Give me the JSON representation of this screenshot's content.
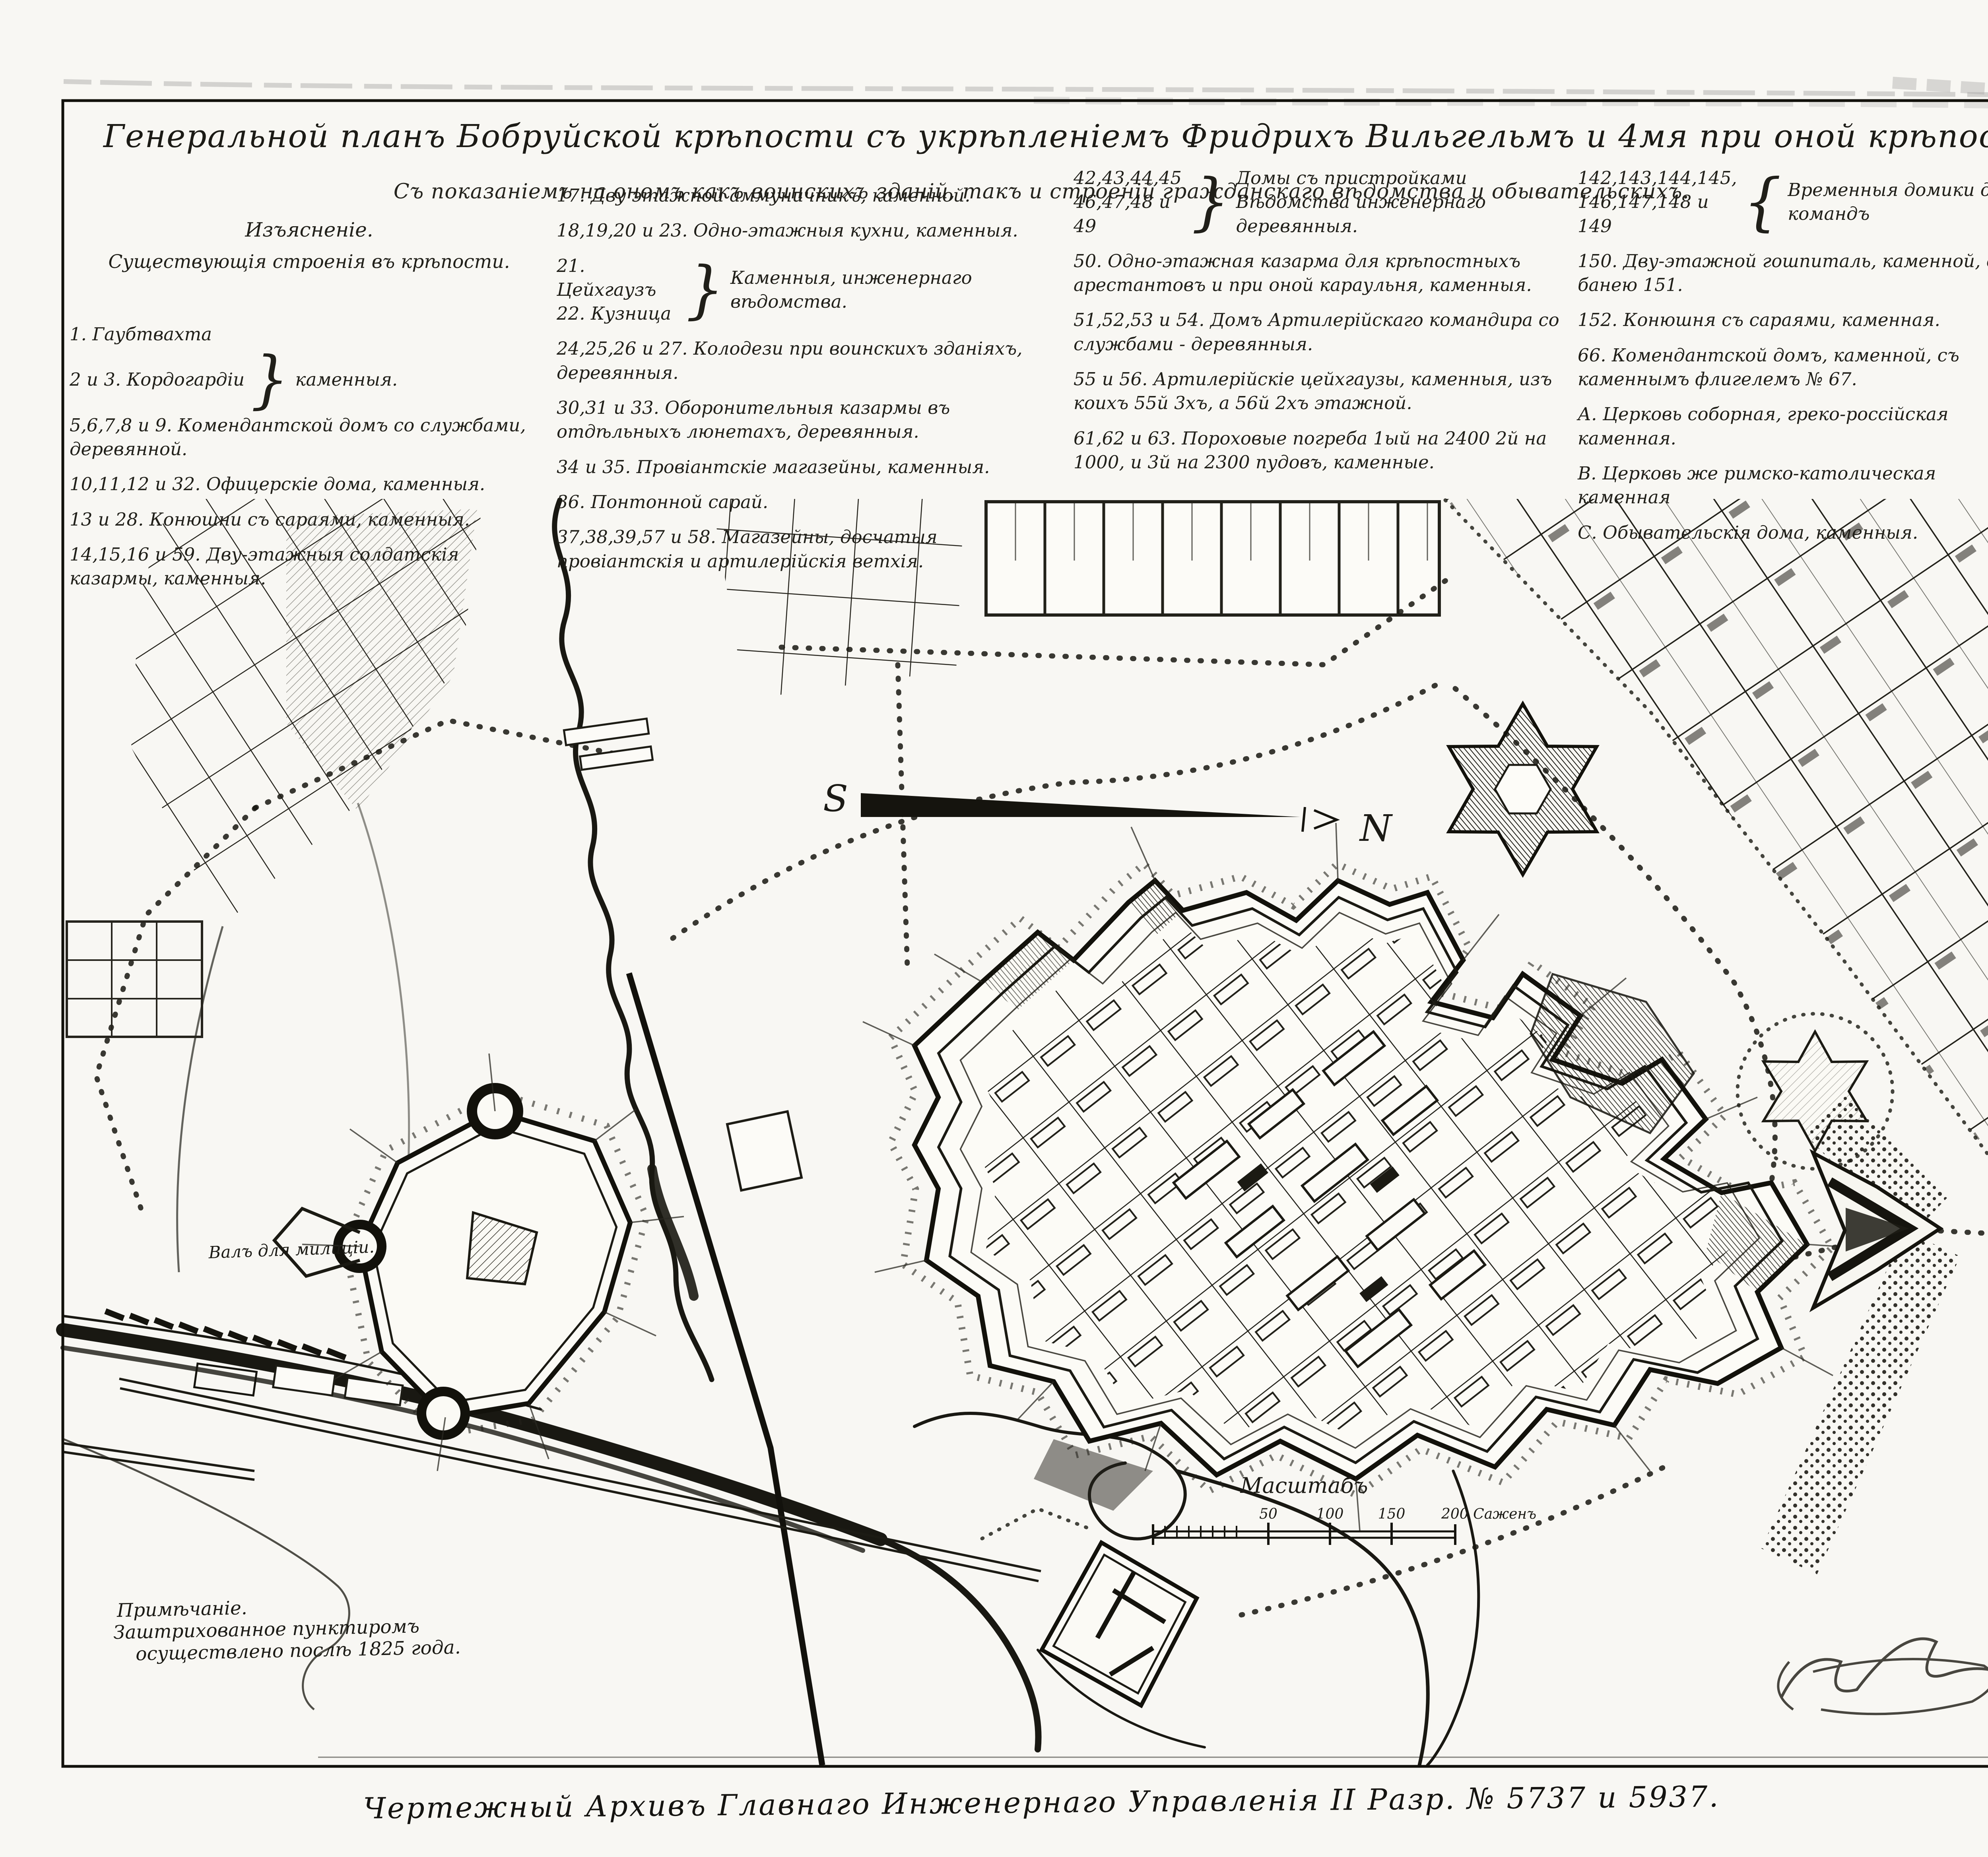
{
  "title": {
    "line1": "Генеральной планъ Бобруйской крѣпости съ укрѣпленіемъ Фридрихъ Вильгельмъ и 4мя при оной крѣпости форштатами.",
    "line2": "Съ показаніемъ на ономъ какъ воинскихъ зданій, такъ и строеній гражданскаго вѣдомства и обывательскихъ."
  },
  "legend": {
    "heading1": "Изъясненіе.",
    "heading2": "Существующія строенія въ крѣпости.",
    "col1": [
      {
        "t": "1. Гаубтвахта"
      },
      {
        "n1": "2 и 3. Кордогардіи",
        "d": "каменныя."
      },
      {
        "t": "5,6,7,8 и 9. Комендантской домъ со службами, деревянной."
      },
      {
        "t": "10,11,12 и 32. Офицерскіе дома, каменныя."
      },
      {
        "t": "13 и 28. Конюшни съ сараями, каменныя."
      },
      {
        "t": "14,15,16 и 59. Дву-этажныя солдатскія казармы, каменныя."
      }
    ],
    "col2": [
      {
        "t": "17. Дву этажной аммуничникъ, каменной."
      },
      {
        "t": "18,19,20 и 23. Одно-этажныя кухни, каменныя."
      },
      {
        "n1": "21. Цейхгаузъ",
        "n2": "22. Кузница",
        "d": "Каменныя, инженернаго вѣдомства."
      },
      {
        "t": "24,25,26 и 27. Колодези при воинскихъ зданіяхъ, деревянныя."
      },
      {
        "t": "30,31 и 33. Оборонительныя казармы въ отдѣльныхъ люнетахъ, деревянныя."
      },
      {
        "t": "34 и 35. Провіантскіе магазейны, каменныя."
      },
      {
        "t": "36. Понтонной сарай."
      },
      {
        "t": "37,38,39,57 и 58. Магазейны, досчатыя провіантскія и артилерійскія ветхія."
      }
    ],
    "col3": [
      {
        "n1": "42,43,44,45",
        "n2": "46,47,48 и 49",
        "d1": "Домы съ пристройками",
        "d2": "Вѣдомства инженернаго деревянныя."
      },
      {
        "t": "50. Одно-этажная казарма для крѣпостныхъ арестантовъ и при оной караульня, каменныя."
      },
      {
        "t": "51,52,53 и 54. Домъ Артилерійскаго командира со службами - деревянныя."
      },
      {
        "t": "55 и 56. Артилерійскіе цейхгаузы, каменныя, изъ коихъ 55й 3хъ, а 56й 2хъ этажной."
      },
      {
        "t": "61,62 и 63. Пороховые погреба 1ый на 2400 2й на 1000, и 3й на 2300 пудовъ, каменные."
      }
    ],
    "col4": [
      {
        "n1": "142,143,144,145,",
        "n2": "146,147,148 и 149",
        "d": "Временныя домики для командъ"
      },
      {
        "t": "150. Дву-этажной гошпиталь, каменной, съ банею 151."
      },
      {
        "t": "152. Конюшня съ сараями, каменная."
      },
      {
        "t": "66. Комендантской домъ, каменной, съ каменнымъ флигелемъ № 67."
      },
      {
        "t": "А. Церковь соборная, греко-россійская каменная."
      },
      {
        "t": "В. Церковь же римско-католическая каменная"
      },
      {
        "t": "С. Обывательскія дома, каменныя."
      }
    ]
  },
  "map": {
    "compass": {
      "south": "S",
      "north": "N"
    },
    "labels": {
      "rampart": "Валъ для милиціи."
    },
    "note": {
      "line1": "Примѣчаніе.",
      "line2": "Заштрихованное пунктиромъ",
      "line3": "осуществлено послѣ 1825 года."
    },
    "scale": {
      "title": "Масштабъ",
      "ticks": [
        "50",
        "100",
        "150"
      ],
      "end": "200 Саженъ"
    }
  },
  "footer": {
    "caption": "Чертежный Архивъ Главнаго Инженернаго Управленія II Разр. № 5737 и 5937."
  }
}
